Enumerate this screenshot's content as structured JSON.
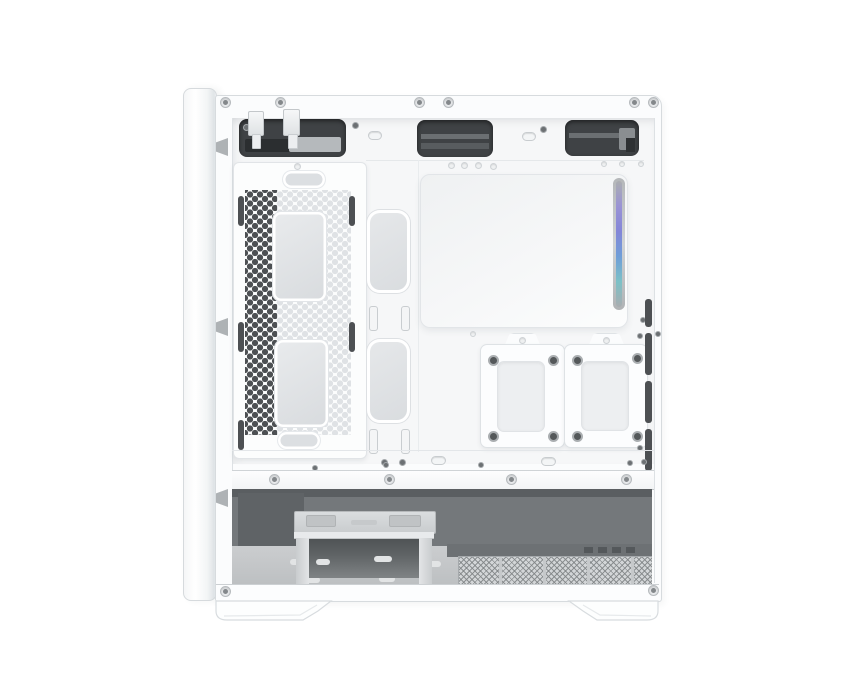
{
  "image": {
    "type": "product-photo",
    "subject": "white compact PC tower case, interior side view with side panel removed",
    "background": "#ffffff"
  },
  "colors": {
    "bg": "#ffffff",
    "case_white": "#fbfcfd",
    "frame_line": "#d7dbde",
    "interior": "#f6f7f8",
    "cutout_dark": "#3f4245",
    "hex_dark": "#4d5053",
    "hex_light": "#dfe2e5",
    "grommet": "#dcdfe2",
    "compartment": "#74787b",
    "floor": "#c5c8ca",
    "mesh": "#d3d6d8",
    "rgb_strip": [
      "#abaeb0",
      "#9a93d5",
      "#8386d8",
      "#6f9ed8",
      "#7cc1c7",
      "#a9adb0"
    ]
  },
  "counts": {
    "top_rivets": 6,
    "top_cable_cutouts": 3,
    "front_panel_cables": 2,
    "cable_cover_grommets": 2,
    "cable_cover_handles": 2,
    "tray_grommets": 2,
    "ssd_trays": 2,
    "screws_per_ssd_tray": 4,
    "shroud_rivets": 4,
    "mesh_sections": 5,
    "side_vent_slots": 4,
    "feet": 2
  },
  "parts": {
    "front_bezel": "front bezel edge",
    "top_cutouts": "top cable-routing cutouts",
    "cables": "front-panel connectors hanging through top cutout",
    "cable_cover": "hexagon-vented cable cover panel",
    "grommets": "rubber-free cable grommet covers",
    "front_panel": "front fan / radiator mounting panel",
    "argb_strip": "addressable RGB light strip",
    "ssd_trays": "removable 2.5-inch SSD trays",
    "psu_shroud_rail": "power-supply compartment rail",
    "drive_cage": "hard-drive cage stand",
    "psu_filter": "power-supply dust-filter mesh",
    "feet": "case feet"
  }
}
